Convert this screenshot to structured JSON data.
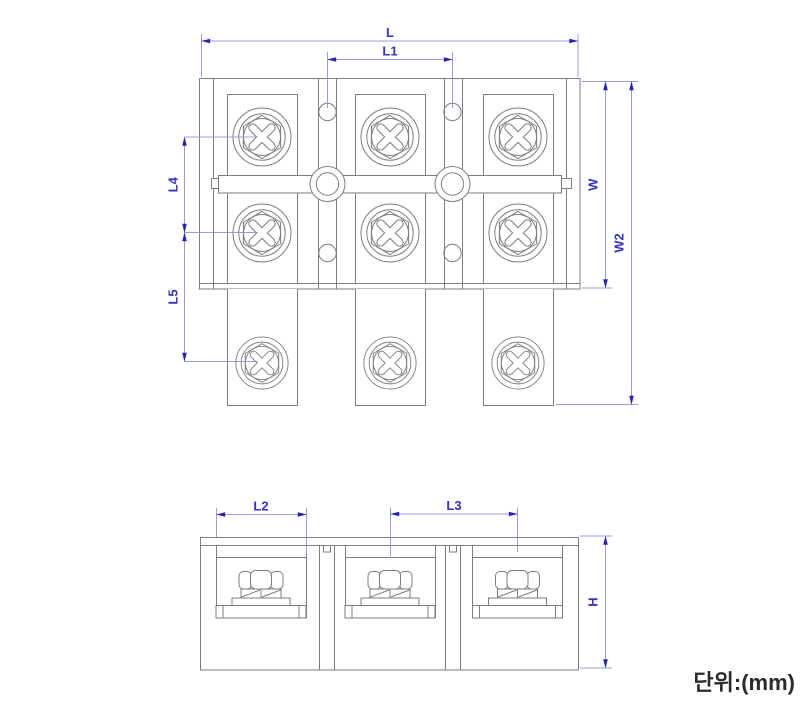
{
  "drawing": {
    "type": "terminal-block engineering drawing, top view and front view",
    "unit_note": "단위:(mm)",
    "dims": {
      "L": "L",
      "L1": "L1",
      "L4": "L4",
      "L5": "L5",
      "W": "W",
      "W2": "W2",
      "L2": "L2",
      "L3": "L3",
      "H": "H"
    },
    "colors": {
      "background": "#ffffff",
      "outline": "#7d7d7d",
      "dimension_line": "#9b9bdc",
      "dimension_text": "#3232cd",
      "arrow": "#2222cc",
      "note_text": "#2b2b2b"
    }
  }
}
